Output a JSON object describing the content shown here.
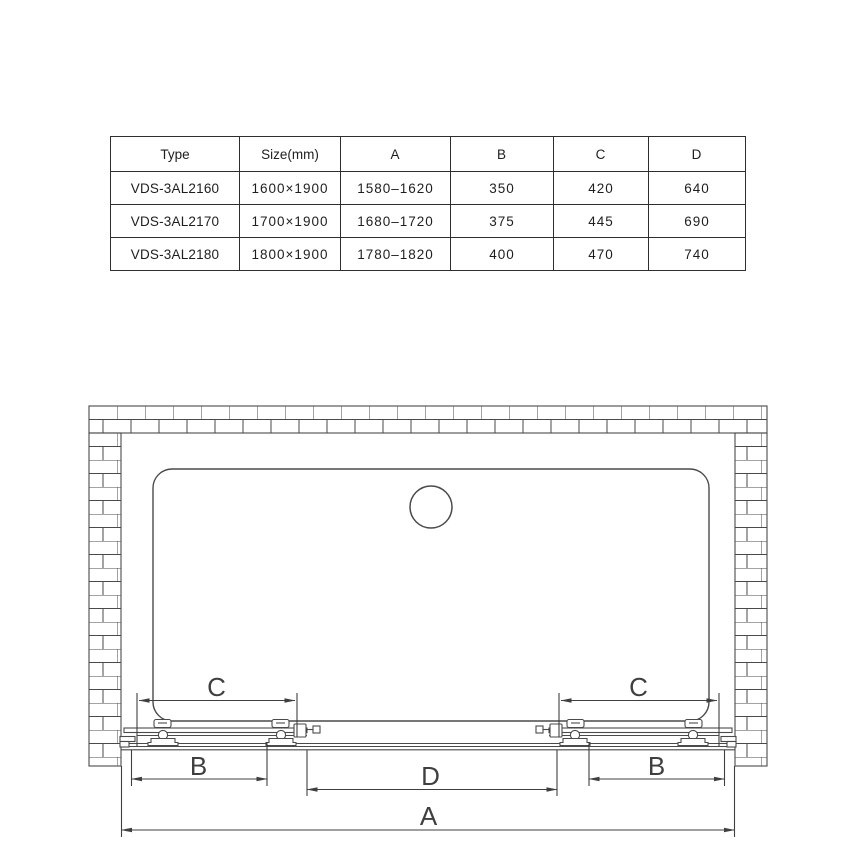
{
  "table": {
    "headers": [
      "Type",
      "Size(mm)",
      "A",
      "B",
      "C",
      "D"
    ],
    "rows": [
      [
        "VDS-3AL2160",
        "1600×1900",
        "1580–1620",
        "350",
        "420",
        "640"
      ],
      [
        "VDS-3AL2170",
        "1700×1900",
        "1680–1720",
        "375",
        "445",
        "690"
      ],
      [
        "VDS-3AL2180",
        "1800×1900",
        "1780–1820",
        "400",
        "470",
        "740"
      ]
    ]
  },
  "diagram": {
    "dims": {
      "a": "A",
      "b_left": "B",
      "b_right": "B",
      "c_left": "C",
      "c_right": "C",
      "d": "D"
    },
    "colors": {
      "line": "#4a4a4a",
      "dimension": "#3f3f3f",
      "table_border": "#2e2e2e",
      "text": "#1e1e1e",
      "background": "#ffffff"
    }
  }
}
